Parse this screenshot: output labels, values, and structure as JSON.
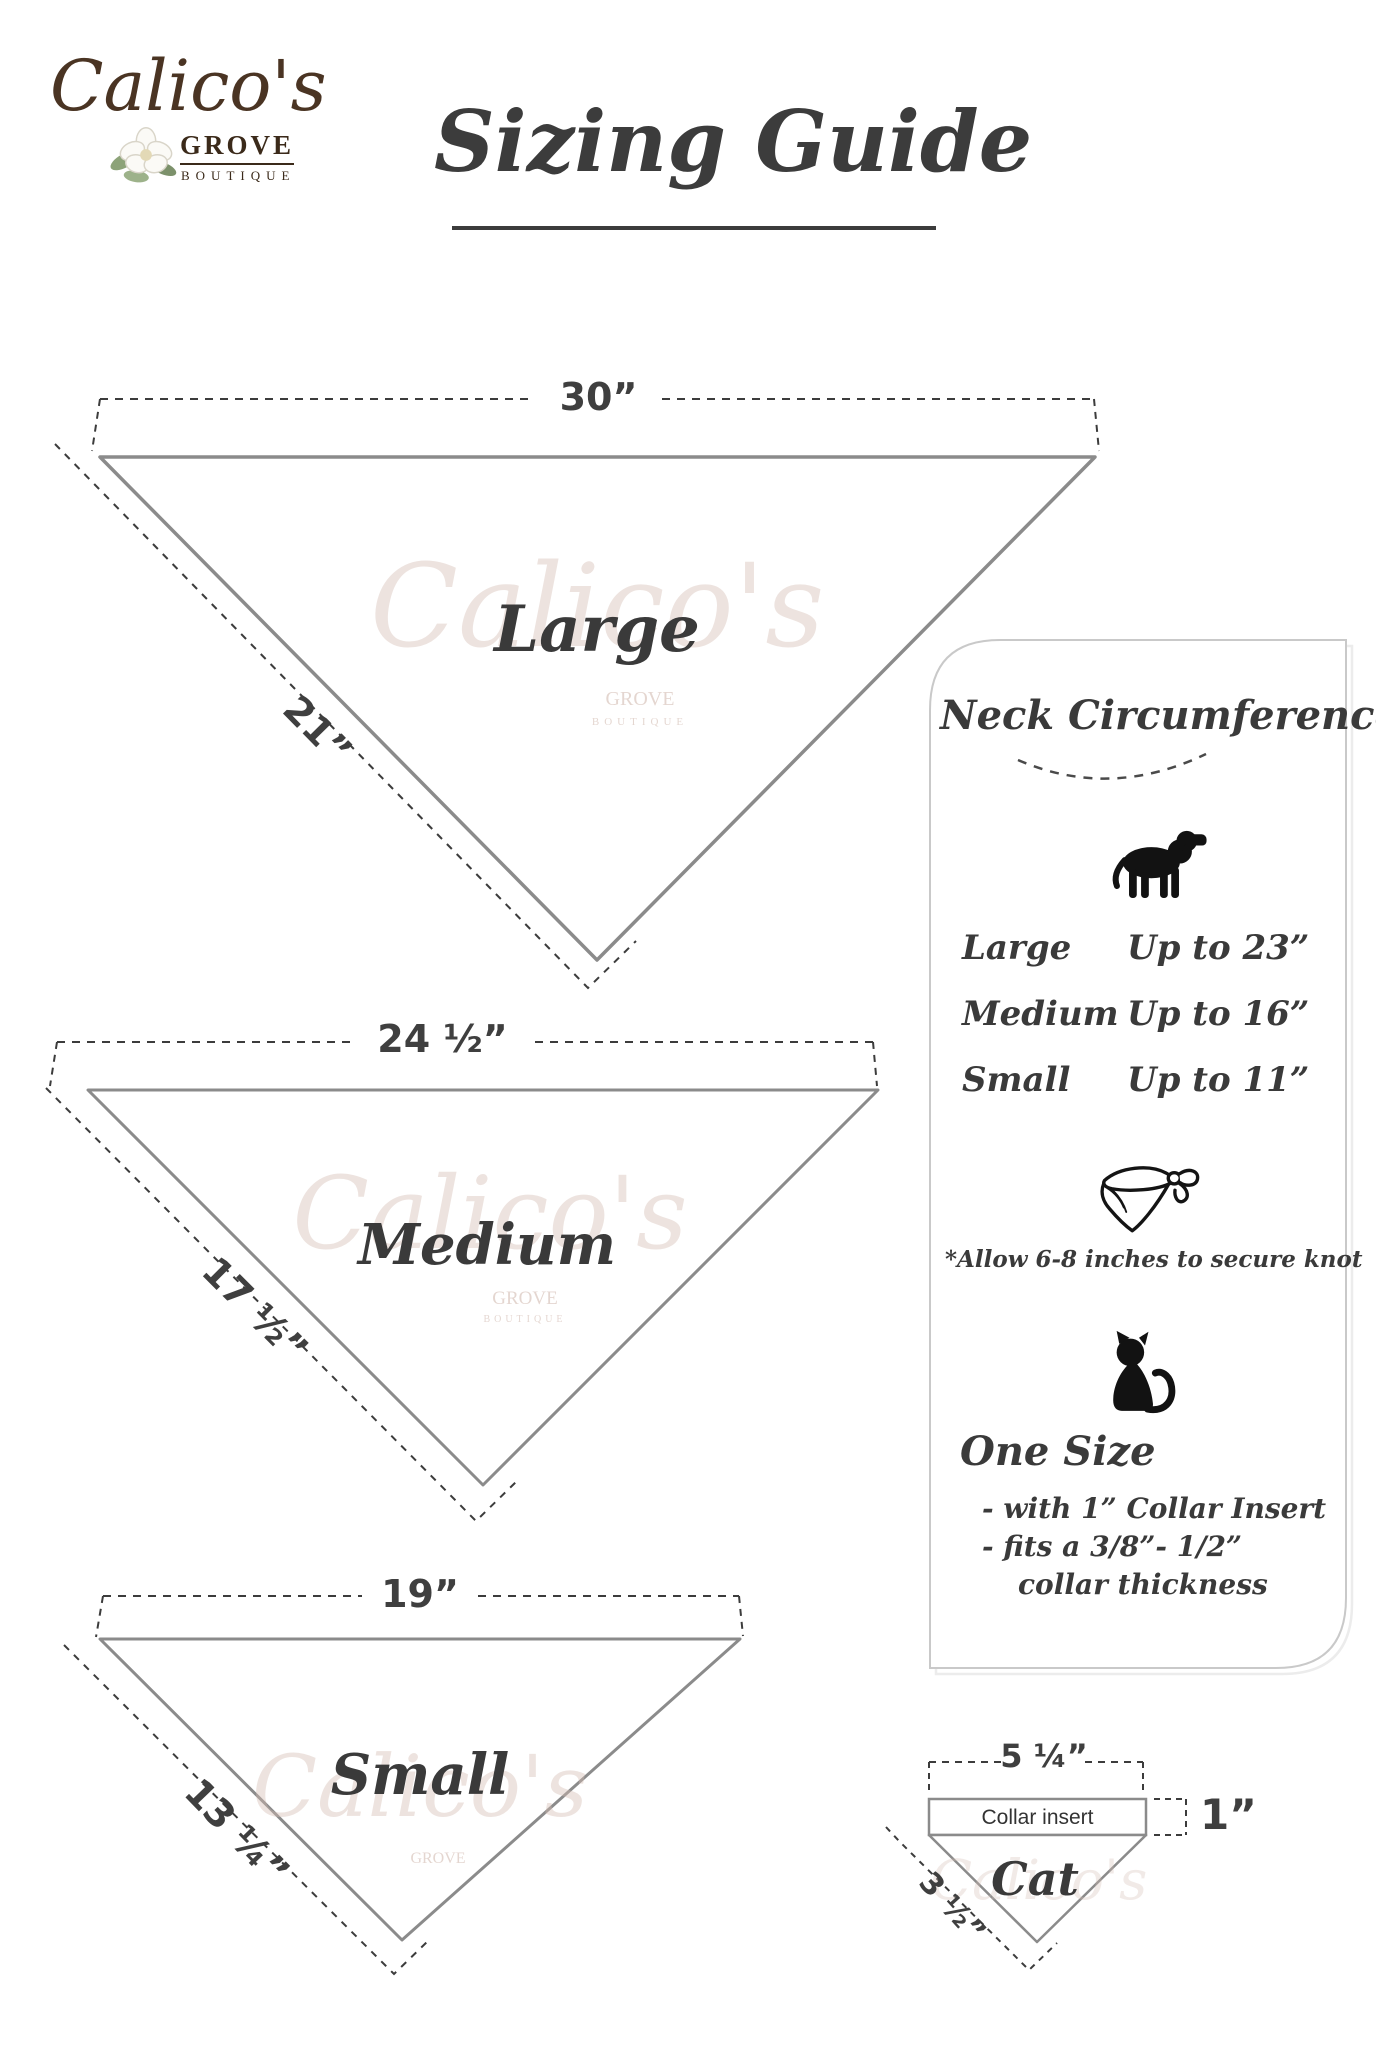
{
  "logo": {
    "name": "Calico's",
    "grove": "GROVE",
    "boutique": "BOUTIQUE"
  },
  "title": {
    "text": "Sizing Guide"
  },
  "watermark": {
    "script": "Calico's",
    "grove": "GROVE",
    "boutique": "BOUTIQUE"
  },
  "triangles": {
    "large": {
      "label": "Large",
      "top": "30”",
      "side": "21”"
    },
    "medium": {
      "label": "Medium",
      "top": "24 ½”",
      "side": "17 ½”"
    },
    "small": {
      "label": "Small",
      "top": "19”",
      "side": "13 ¼”"
    }
  },
  "panel": {
    "heading": "Neck Circumference",
    "rows": [
      {
        "size": "Large",
        "value": "Up to 23”"
      },
      {
        "size": "Medium",
        "value": "Up to 16”"
      },
      {
        "size": "Small",
        "value": "Up to 11”"
      }
    ],
    "knot_note": "*Allow 6-8 inches to secure knot",
    "one_size": {
      "heading": "One Size",
      "line1": "- with 1” Collar Insert",
      "line2": "- fits a 3/8”- 1/2”",
      "line3": "collar thickness"
    },
    "icons": {
      "dog": "dog-silhouette",
      "bandana": "tied-bandana",
      "cat": "cat-silhouette"
    }
  },
  "cat_diagram": {
    "top": "5 ¼”",
    "insert": "Collar insert",
    "height": "1”",
    "label": "Cat",
    "side": "3 ½”"
  },
  "colors": {
    "ink": "#3d3d3d",
    "triangle_outline": "#8b8b8b",
    "logo_brown": "#4a3423",
    "panel_border": "#c9c9c9",
    "watermark": "#d8bfb4"
  }
}
